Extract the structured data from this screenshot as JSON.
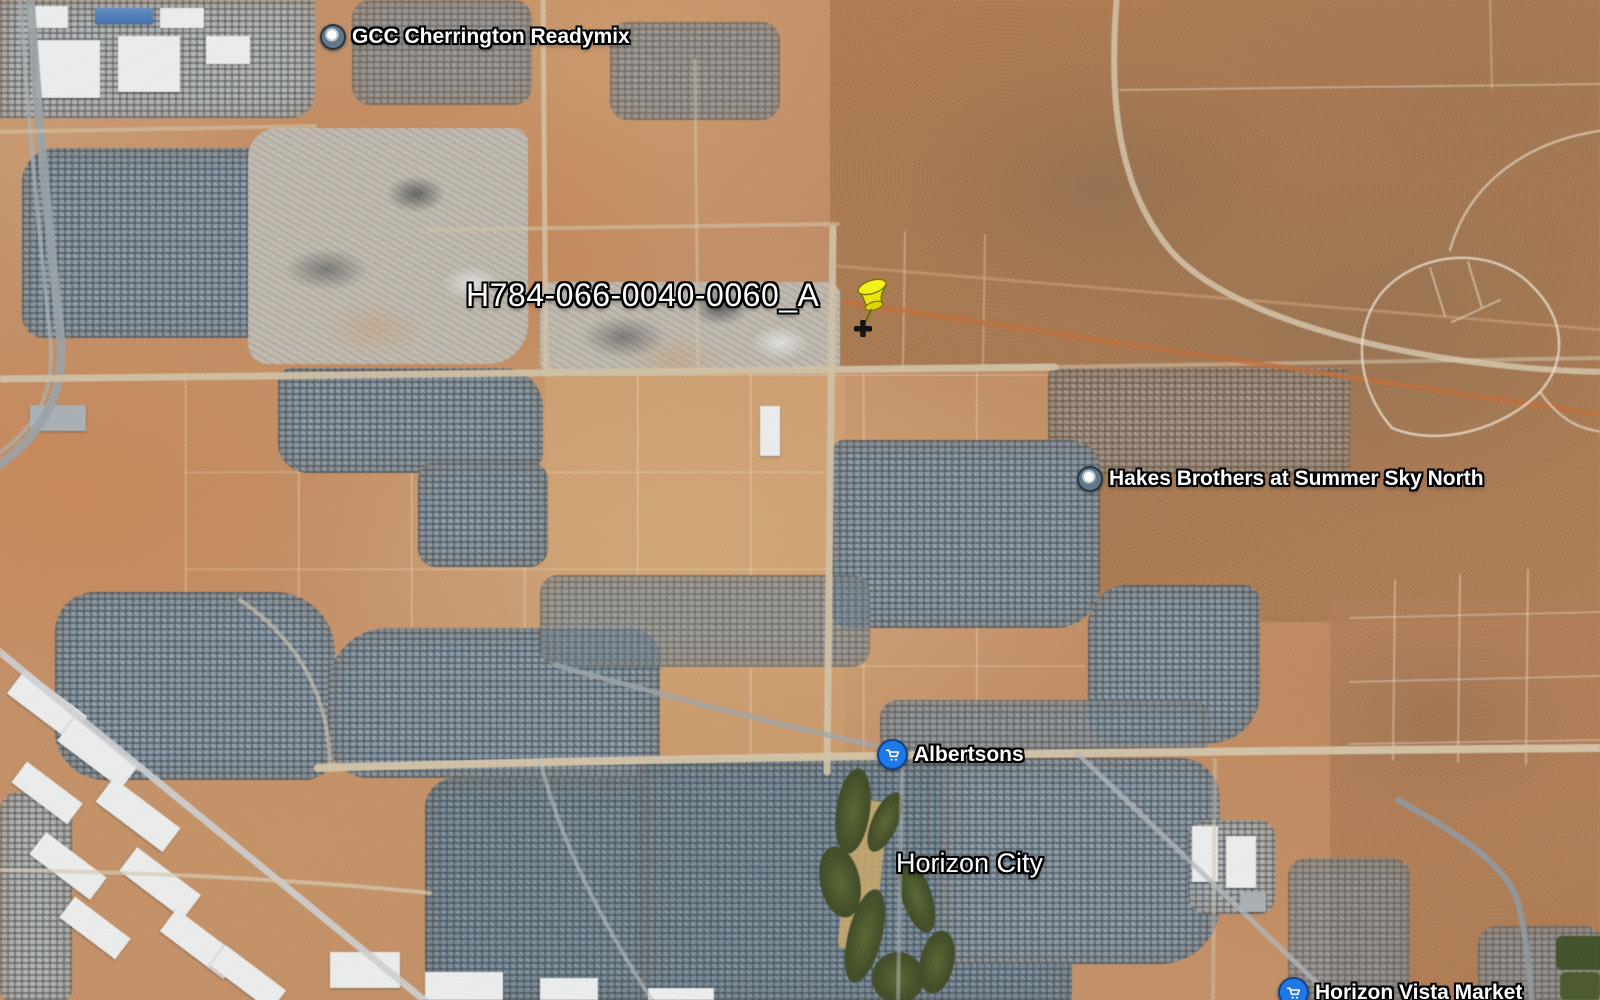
{
  "view": {
    "type": "satellite-imagery"
  },
  "labels": {
    "readymix": "GCC Cherrington Readymix",
    "parcel_pin": "H784-066-0040-0060_A",
    "hakes": "Hakes Brothers at Summer Sky North",
    "albertsons": "Albertsons",
    "horizon_city": "Horizon City",
    "horizon_vista": "Horizon Vista Market"
  },
  "icons": {
    "readymix_marker": "poi-ring-icon",
    "hakes_marker": "poi-ring-icon",
    "albertsons_marker": "shopping-cart-marker-icon",
    "horizon_vista_marker": "shopping-cart-marker-icon",
    "parcel_marker": "yellow-pushpin-icon"
  },
  "colors": {
    "desert_base": "#c49067",
    "desert_dark_ne": "#a87a52",
    "urban_rooftop": "#8799a7",
    "road_dirt": "#d6c7ab",
    "road_paved": "#98a2aa",
    "golf_green": "#3d4d26",
    "pushpin_yellow": "#ece80e",
    "store_marker_blue": "#1e78e8",
    "label_text": "#ffffff",
    "label_outline": "#000000"
  }
}
